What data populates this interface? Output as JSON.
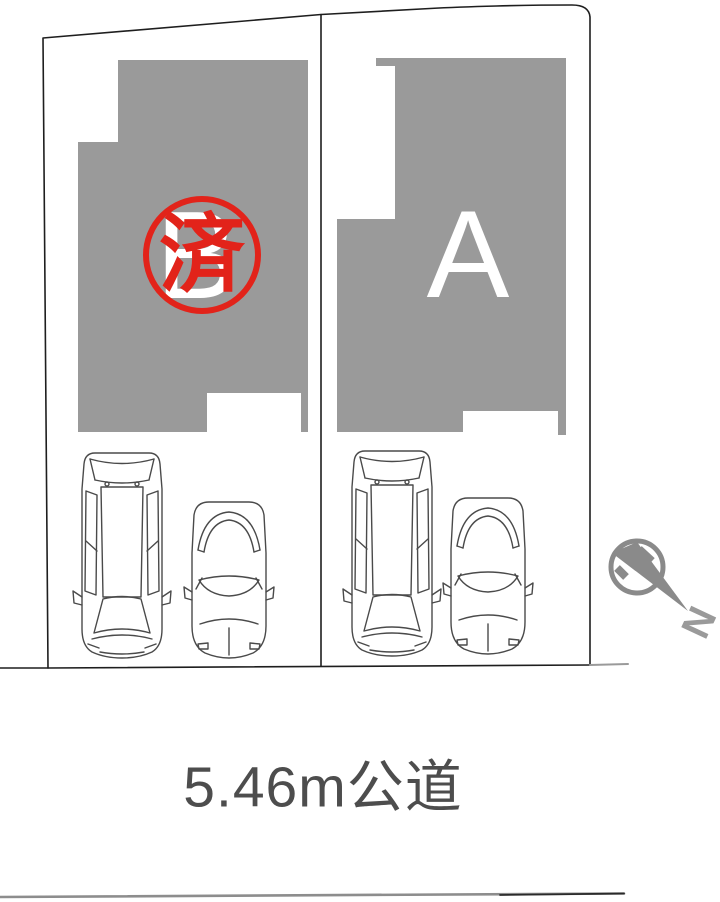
{
  "plan": {
    "lots": [
      {
        "label": "B",
        "stamp": "済"
      },
      {
        "label": "A"
      }
    ],
    "road_label": "5.46m公道",
    "north_label": "N"
  },
  "icons": {
    "compass": "north-compass-pin-icon",
    "cars": [
      "van-top-view-icon",
      "sedan-top-view-icon"
    ],
    "stamp": "sold-stamp-circle"
  },
  "colors": {
    "building_gray": "#9a9a9a",
    "stamp_red": "#e2231a",
    "boundary_line": "#1e1e1e",
    "car_line": "#4a4a4a",
    "compass_gray": "#8a8a8a",
    "road_text": "#4d4d4d",
    "lot_letter_white": "#ffffff"
  }
}
